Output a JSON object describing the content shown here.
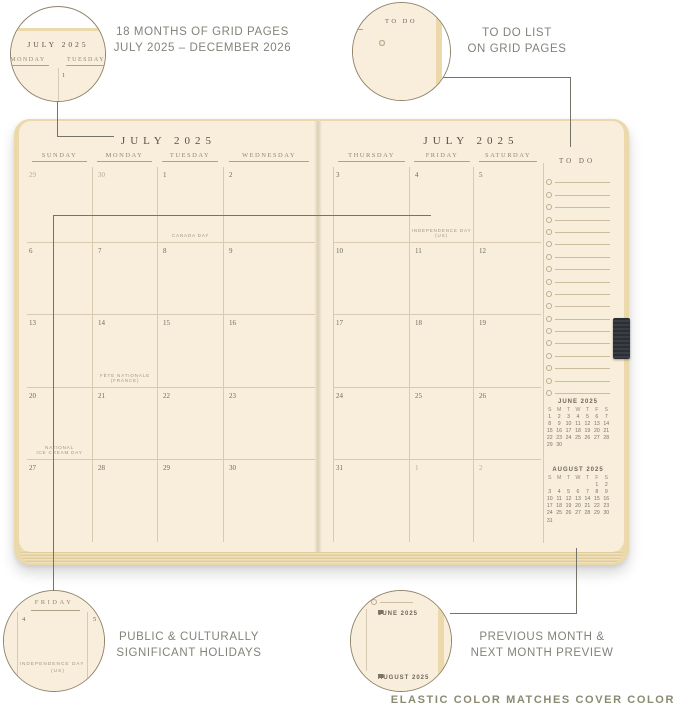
{
  "colors": {
    "page_cream": "#f8eedb",
    "cover_edge_tan": "#ecd9ab",
    "grid_line": "#d7cab0",
    "leader_line": "#73736a",
    "callout_text": "#83837a",
    "elastic_charcoal": "#2b2e33"
  },
  "callouts": {
    "months_range": {
      "line1": "18 MONTHS OF GRID PAGES",
      "line2": "JULY 2025 – DECEMBER 2026"
    },
    "todo": {
      "line1": "TO DO LIST",
      "line2": "ON GRID PAGES"
    },
    "holidays": {
      "line1": "PUBLIC & CULTURALLY",
      "line2": "SIGNIFICANT HOLIDAYS"
    },
    "preview": {
      "line1": "PREVIOUS MONTH &",
      "line2": "NEXT MONTH PREVIEW"
    }
  },
  "footer": {
    "label": "ELASTIC COLOR MATCHES COVER COLOR"
  },
  "planner": {
    "left_page": {
      "title": "JULY 2025",
      "day_headers": [
        "SUNDAY",
        "MONDAY",
        "TUESDAY",
        "WEDNESDAY"
      ],
      "rows": [
        [
          {
            "d": "29",
            "m": true
          },
          {
            "d": "30",
            "m": true
          },
          {
            "d": "1",
            "h": "CANADA DAY"
          },
          {
            "d": "2"
          }
        ],
        [
          {
            "d": "6"
          },
          {
            "d": "7"
          },
          {
            "d": "8"
          },
          {
            "d": "9"
          }
        ],
        [
          {
            "d": "13"
          },
          {
            "d": "14",
            "h": "FÊTE NATIONALE\n(FRANCE)"
          },
          {
            "d": "15"
          },
          {
            "d": "16"
          }
        ],
        [
          {
            "d": "20",
            "h": "NATIONAL\nICE CREAM DAY"
          },
          {
            "d": "21"
          },
          {
            "d": "22"
          },
          {
            "d": "23"
          }
        ],
        [
          {
            "d": "27"
          },
          {
            "d": "28"
          },
          {
            "d": "29"
          },
          {
            "d": "30"
          }
        ]
      ]
    },
    "right_page": {
      "title": "JULY 2025",
      "day_headers": [
        "THURSDAY",
        "FRIDAY",
        "SATURDAY"
      ],
      "rows": [
        [
          {
            "d": "3"
          },
          {
            "d": "4",
            "h": "INDEPENDENCE DAY\n(US)"
          },
          {
            "d": "5"
          }
        ],
        [
          {
            "d": "10"
          },
          {
            "d": "11"
          },
          {
            "d": "12"
          }
        ],
        [
          {
            "d": "17"
          },
          {
            "d": "18"
          },
          {
            "d": "19"
          }
        ],
        [
          {
            "d": "24"
          },
          {
            "d": "25"
          },
          {
            "d": "26"
          }
        ],
        [
          {
            "d": "31"
          },
          {
            "d": "1",
            "m": true
          },
          {
            "d": "2",
            "m": true
          }
        ]
      ],
      "todo": {
        "label": "TO DO",
        "item_count": 18
      },
      "mini_months": [
        {
          "title": "JUNE 2025",
          "dow": [
            "S",
            "M",
            "T",
            "W",
            "T",
            "F",
            "S"
          ],
          "weeks": [
            [
              "1",
              "2",
              "3",
              "4",
              "5",
              "6",
              "7"
            ],
            [
              "8",
              "9",
              "10",
              "11",
              "12",
              "13",
              "14"
            ],
            [
              "15",
              "16",
              "17",
              "18",
              "19",
              "20",
              "21"
            ],
            [
              "22",
              "23",
              "24",
              "25",
              "26",
              "27",
              "28"
            ],
            [
              "29",
              "30",
              "",
              "",
              "",
              "",
              ""
            ]
          ]
        },
        {
          "title": "AUGUST 2025",
          "dow": [
            "S",
            "M",
            "T",
            "W",
            "T",
            "F",
            "S"
          ],
          "weeks": [
            [
              "",
              "",
              "",
              "",
              "",
              "1",
              "2"
            ],
            [
              "3",
              "4",
              "5",
              "6",
              "7",
              "8",
              "9"
            ],
            [
              "10",
              "11",
              "12",
              "13",
              "14",
              "15",
              "16"
            ],
            [
              "17",
              "18",
              "19",
              "20",
              "21",
              "22",
              "23"
            ],
            [
              "24",
              "25",
              "26",
              "27",
              "28",
              "29",
              "30"
            ],
            [
              "31",
              "",
              "",
              "",
              "",
              "",
              ""
            ]
          ]
        }
      ]
    }
  },
  "zoom_circles": {
    "grid_page": {
      "title": "JULY 2025",
      "days": [
        "MONDAY",
        "TUESDAY"
      ],
      "date": "1"
    },
    "todo_list": {
      "label": "TO DO",
      "item_count": 7
    },
    "holiday": {
      "day": "FRIDAY",
      "dates": [
        "4",
        "5"
      ],
      "holiday_line1": "INDEPENDENCE DAY",
      "holiday_line2": "(US)"
    }
  }
}
